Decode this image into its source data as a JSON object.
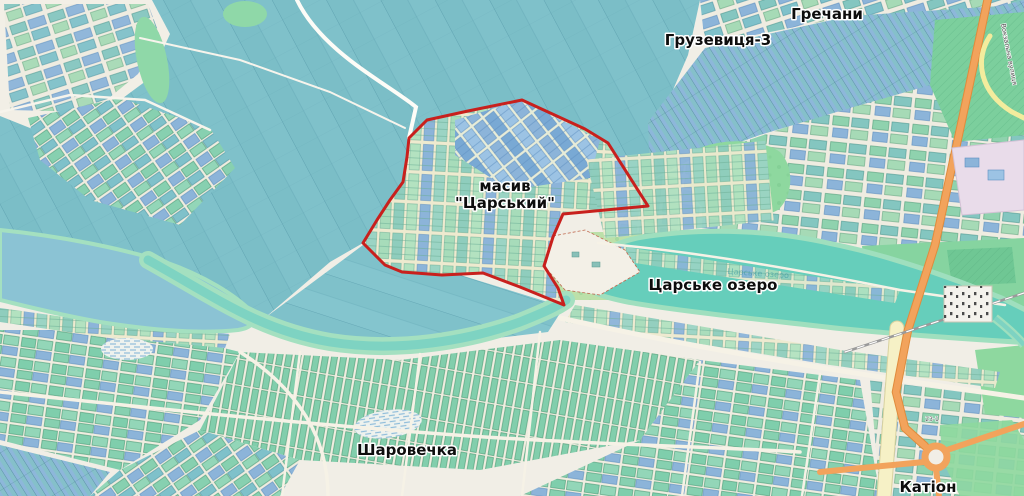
{
  "map": {
    "type": "openstreetmap-style area map with highlighted allotment massif",
    "labels": {
      "hrechany": "Гречани",
      "hruzevytsia": "Грузевиця-3",
      "masyv_line1": "масив",
      "masyv_line2": "\"Царський\"",
      "lake": "Царське озеро",
      "lake_small": "Царське озеро",
      "sharovechka": "Шаровечка",
      "kation": "Катіон",
      "street_vertical": "Вокзальна вулиця",
      "ref_23_1": "23-1"
    },
    "highlight": {
      "name": "масив \"Царський\" boundary",
      "shape": "irregular polygon outline"
    },
    "colors": {
      "boundary_red": "#c8201d",
      "lake_turquoise": "#66cebb",
      "water_blue": "#8bc3d4",
      "shore_green": "#a4e0c0",
      "field_teal": "#7fc1ca",
      "parcel_blue": "#8cb4d9",
      "parcel_green": "#a7dcba",
      "meadow_green": "#8ed89f",
      "road_orange": "#f2a35c",
      "road_yellow_pale": "#f6f1c6",
      "background_cream": "#f1eee6"
    }
  }
}
